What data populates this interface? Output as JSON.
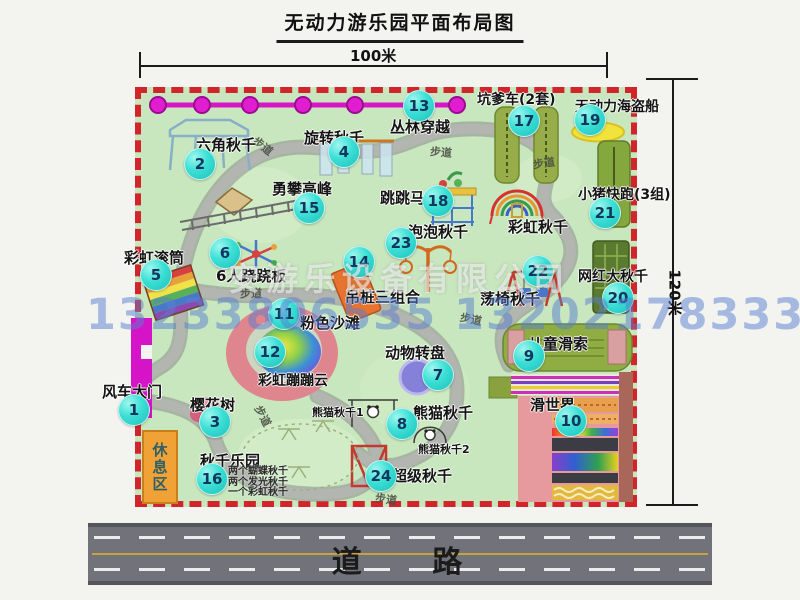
{
  "title": "无动力游乐园平面布局图",
  "dims": {
    "width_label": "100米",
    "height_label": "120米"
  },
  "road": {
    "label": "道 路"
  },
  "watermark": {
    "company": "安游乐设备有限公司",
    "phone": "13233806535 13202178333"
  },
  "rest_area": {
    "label": "休息区"
  },
  "walkway": {
    "label": "步道"
  },
  "extra": {
    "rainbow_swing": "彩虹秋千",
    "panda_swing_1": "熊猫秋千1",
    "panda_swing_2": "熊猫秋千2"
  },
  "attractions": [
    {
      "num": "1",
      "name": "风车大门"
    },
    {
      "num": "2",
      "name": "六角秋千"
    },
    {
      "num": "3",
      "name": "樱花树"
    },
    {
      "num": "4",
      "name": "旋转秋千"
    },
    {
      "num": "5",
      "name": "彩虹滚筒"
    },
    {
      "num": "6",
      "name": "6人跷跷板"
    },
    {
      "num": "7",
      "name": "动物转盘"
    },
    {
      "num": "8",
      "name": "熊猫秋千"
    },
    {
      "num": "9",
      "name": "儿童滑索"
    },
    {
      "num": "10",
      "name": "滑世界"
    },
    {
      "num": "11",
      "name": "粉色沙滩"
    },
    {
      "num": "12",
      "name": "彩虹蹦蹦云"
    },
    {
      "num": "13",
      "name": "丛林穿越"
    },
    {
      "num": "14",
      "name": "吊桩三组合"
    },
    {
      "num": "15",
      "name": "勇攀高峰"
    },
    {
      "num": "16",
      "name": "秋千乐园",
      "notes": [
        "两个蝴蝶秋千",
        "两个发光秋千",
        "一个彩虹秋千"
      ]
    },
    {
      "num": "17",
      "name": "坑爹车(2套)"
    },
    {
      "num": "18",
      "name": "跳跳马"
    },
    {
      "num": "19",
      "name": "无动力海盗船"
    },
    {
      "num": "20",
      "name": "网红大秋千"
    },
    {
      "num": "21",
      "name": "小猪快跑(3组)"
    },
    {
      "num": "22",
      "name": "荡椅秋千"
    },
    {
      "num": "23",
      "name": "泡泡秋千"
    },
    {
      "num": "24",
      "name": "超级秋千"
    }
  ],
  "colors": {
    "map_green": "#c8e7bf",
    "border_red": "#d2252b",
    "badge_cyan": "#3bdfd5",
    "zipline_magenta": "#d916c6",
    "path_gray": "#a7aaa6",
    "road_gray": "#71727a",
    "watermark_blue": "#587ed0",
    "rest_area_orange": "#f0a237",
    "gate_magenta": "#d414c6"
  }
}
